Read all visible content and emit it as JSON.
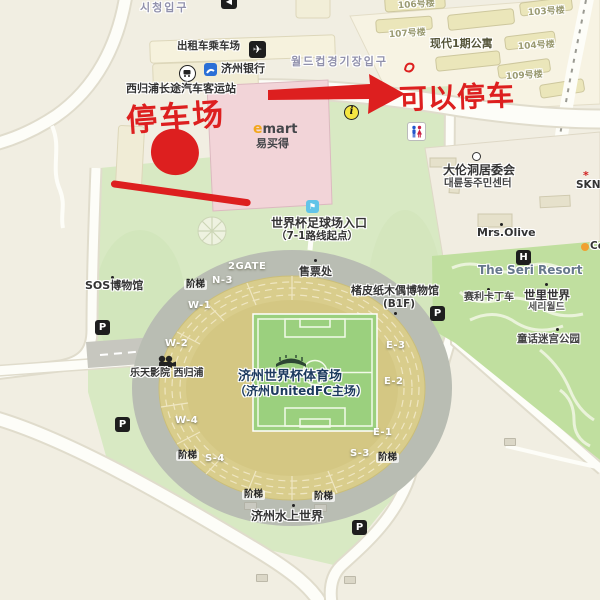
{
  "korean": {
    "city_hall": "시청입구",
    "worldcup_entrance": "월드컵경기장입구"
  },
  "terminal": {
    "taxi_stand": "出租车乘车场",
    "jeju_bank": "济州银行",
    "bus_terminal": "西归浦长途汽车客运站"
  },
  "emart": {
    "logo_e": "e",
    "logo_mart": "mart",
    "name_cn": "易买得"
  },
  "apartments": {
    "complex_name": "现代1期公寓",
    "buildings": [
      "106号楼",
      "107号楼",
      "103号楼",
      "104号楼",
      "109号楼"
    ]
  },
  "red": {
    "parking_lot": "停车场",
    "can_park": "可以停车"
  },
  "right_area": {
    "committee_cn": "大伦洞居委会",
    "committee_kr": "대륜동주민센터",
    "sk": "SKN",
    "mrs_olive": "Mrs.Olive",
    "seri_resort": "The Seri Resort",
    "seri_world_cn": "世里世界",
    "seri_world_kr": "세리월드",
    "gokart": "赛利卡丁车",
    "maze_park": "童话迷宫公园",
    "edge_poi": "Ce"
  },
  "left_area": {
    "sos_museum": "SOS博物馆",
    "lotte_cinema": "乐天影院 西归浦"
  },
  "stadium": {
    "entrance1": "世界杯足球场入口",
    "entrance2": "（7-1路线起点）",
    "ticket_office": "售票处",
    "museum1": "楮皮纸木偶博物馆",
    "museum2": "(B1F)",
    "name1": "济州世界杯体育场",
    "name2": "（济州UnitedFC主场）",
    "gates": [
      "2GATE",
      "N-3",
      "W-1",
      "W-2",
      "W-4",
      "S-4",
      "S-3",
      "E-1",
      "E-2",
      "E-3"
    ],
    "stairs": "阶梯",
    "water_world": "济州水上世界"
  },
  "icons": {
    "parking": "P",
    "hotel": "H",
    "info": "i",
    "airplane": "✈",
    "station": "◀",
    "flag": "⚑",
    "sk_mark": "*"
  },
  "colors": {
    "annotation_red": "#dd1f1f",
    "map_bg": "#f1eee2",
    "plaza_green": "#d8e9c3",
    "park_green": "#c0df9f",
    "emart_pink": "#f2d4d8",
    "stand_khaki": "#d9cd8c",
    "pitch_green": "#9bd07e",
    "ring_gray": "#b9bdb3",
    "emart_e_orange": "#f2a71d",
    "korean_label": "#9191ac"
  }
}
